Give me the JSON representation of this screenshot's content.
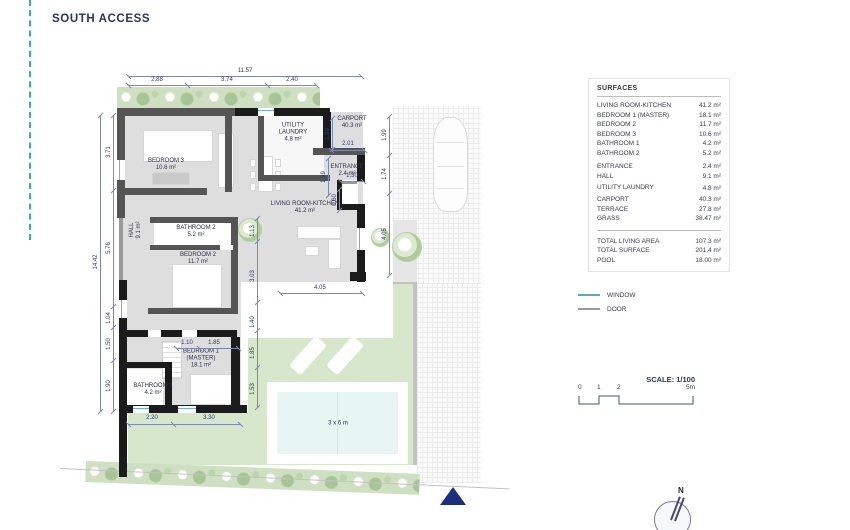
{
  "title": "SOUTH ACCESS",
  "surfaces": {
    "header": "SURFACES",
    "rows": [
      {
        "label": "LIVING ROOM-KITCHEN",
        "value": "41.2 m²"
      },
      {
        "label": "BEDROOM 1 (MASTER)",
        "value": "18.1 m²"
      },
      {
        "label": "BEDROOM 2",
        "value": "11.7 m²"
      },
      {
        "label": "BEDROOM 3",
        "value": "10.6 m²"
      },
      {
        "label": "BATHROOM 1",
        "value": "4.2 m²"
      },
      {
        "label": "BATHROOM 2",
        "value": "5.2 m²"
      },
      {
        "label": "ENTRANCE",
        "value": "2.4 m²"
      },
      {
        "label": "HALL",
        "value": "9.1 m²"
      },
      {
        "label": "UTILITY LAUNDRY",
        "value": "4.8 m²"
      },
      {
        "label": "CARPORT",
        "value": "40.3 m²"
      },
      {
        "label": "TERRACE",
        "value": "27.8 m²"
      },
      {
        "label": "GRASS",
        "value": "38.47 m²"
      }
    ],
    "totals": [
      {
        "label": "TOTAL LIVING AREA",
        "value": "107.3 m²"
      },
      {
        "label": "TOTAL SURFACE",
        "value": "201,4 m²"
      },
      {
        "label": "POOL",
        "value": "18.00 m²"
      }
    ]
  },
  "legend": {
    "window": "WINDOW",
    "door": "DOOR"
  },
  "scale": {
    "label": "SCALE: 1/100",
    "ticks": [
      "0",
      "1",
      "2",
      "5m"
    ]
  },
  "north_label": "N",
  "plan": {
    "rooms": [
      {
        "name": "BEDROOM 3",
        "area": "10.6 m²"
      },
      {
        "name": "UTILITY LAUNDRY",
        "area": "4.8 m²"
      },
      {
        "name": "CARPORT",
        "area": "40.3 m²"
      },
      {
        "name": "ENTRANCE",
        "area": "2.4 m²"
      },
      {
        "name": "LIVING ROOM-KITCHEN",
        "area": "41.2 m²"
      },
      {
        "name": "HALL",
        "area": "9.1 m²"
      },
      {
        "name": "BATHROOM 2",
        "area": "5.2 m²"
      },
      {
        "name": "BEDROOM 2",
        "area": "11.7 m²"
      },
      {
        "name": "BEDROOM 1 (MASTER)",
        "area": "18.1 m²"
      },
      {
        "name": "BATHROOM 1",
        "area": "4.2 m²"
      }
    ],
    "pool_label": "3 x 6 m",
    "dims": [
      "11.57",
      "2.88",
      "3.74",
      "2.40",
      "14.42",
      "3.71",
      "5.76",
      "1.04",
      "1.50",
      "1.90",
      "1.99",
      "1.99",
      "2.01",
      "1.99",
      "1.74",
      "4.05",
      "1.30",
      "0.60",
      "1.13",
      "3.03",
      "1.40",
      "1.85",
      "1.53",
      "4.05",
      "1.10",
      "1.85",
      "2.20",
      "3.30"
    ]
  },
  "colors": {
    "accent_navy": "#29306a",
    "dim_line": "#7c8ab0",
    "wall_black": "#1b1b1b",
    "wall_gray": "#555555",
    "floor_gray": "#dedede",
    "grass_green": "#d6e7cb",
    "hedge_green": "#cfe0c2",
    "pool_cyan": "#e7f5f3",
    "window_blue": "#56a8cf",
    "door_gray": "#9a9a9a",
    "access_triangle": "#1b2f7e",
    "guide_teal": "#39abab"
  }
}
